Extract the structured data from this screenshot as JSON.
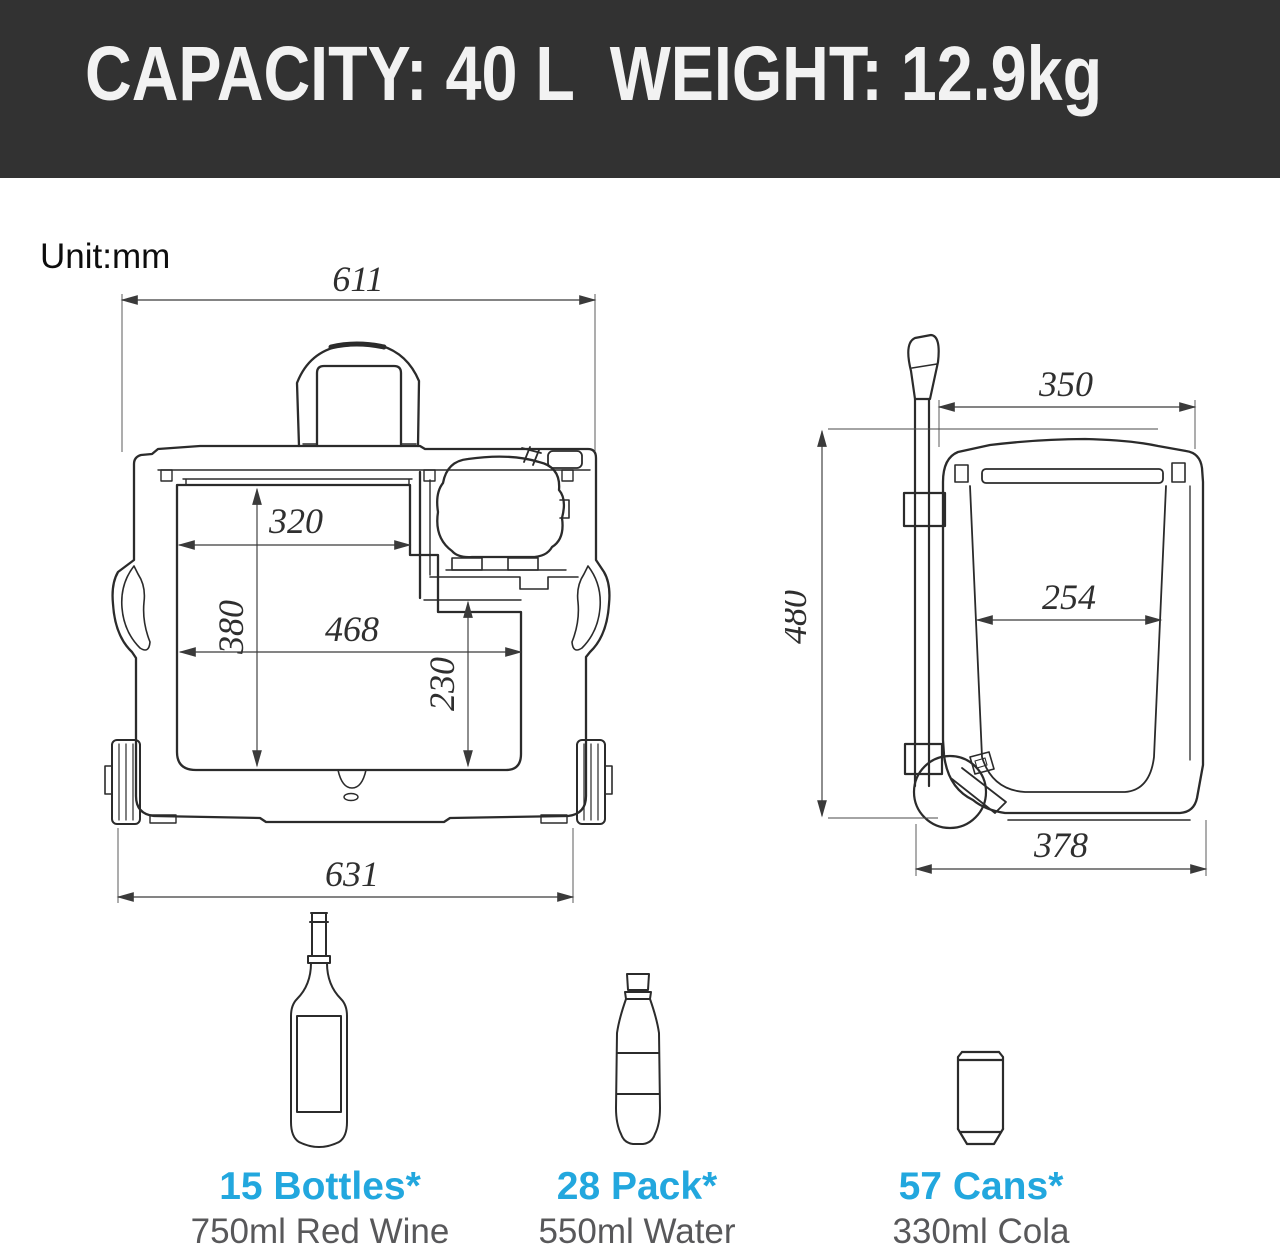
{
  "banner": {
    "title": "CAPACITY: 40 L  WEIGHT: 12.9kg"
  },
  "unit_label": "Unit:mm",
  "front_view": {
    "dims": {
      "top_width": "611",
      "inner_width_upper": "320",
      "inner_height": "380",
      "inner_width_lower": "468",
      "right_inner_height": "230",
      "bottom_width": "631"
    }
  },
  "side_view": {
    "dims": {
      "top_width": "350",
      "height": "480",
      "inner_width": "254",
      "bottom_width": "378"
    }
  },
  "capacity_items": [
    {
      "count": "15 Bottles*",
      "desc": "750ml Red Wine"
    },
    {
      "count": "28 Pack*",
      "desc": "550ml Water"
    },
    {
      "count": "57 Cans*",
      "desc": "330ml Cola"
    }
  ],
  "colors": {
    "banner_bg": "#323232",
    "banner_fg": "#f2f2f2",
    "accent_blue": "#22a7de",
    "label_gray": "#58585a",
    "line_dark": "#2b2b2b"
  }
}
